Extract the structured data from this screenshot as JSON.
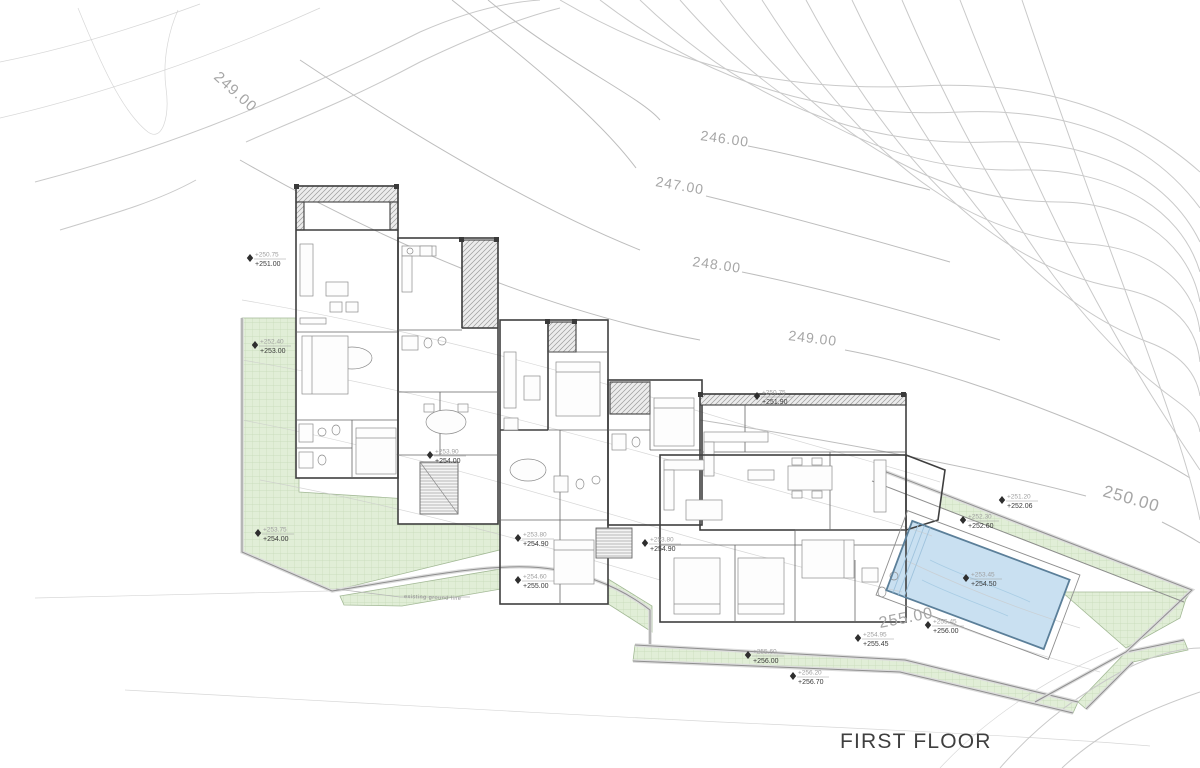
{
  "title": {
    "label": "FIRST FLOOR"
  },
  "plan": {
    "contour_labels": [
      {
        "text": "249.00",
        "x": 213,
        "y": 78,
        "rot": 42,
        "size": 15
      },
      {
        "text": "246.00",
        "x": 700,
        "y": 140,
        "rot": 8,
        "size": 14
      },
      {
        "text": "247.00",
        "x": 655,
        "y": 186,
        "rot": 10,
        "size": 14
      },
      {
        "text": "248.00",
        "x": 692,
        "y": 266,
        "rot": 8,
        "size": 14
      },
      {
        "text": "249.00",
        "x": 788,
        "y": 340,
        "rot": 7,
        "size": 14
      },
      {
        "text": "250.00",
        "x": 1102,
        "y": 496,
        "rot": 16,
        "size": 17
      },
      {
        "text": "255.00",
        "x": 880,
        "y": 628,
        "rot": -11,
        "size": 16
      }
    ],
    "elevation_markers": [
      {
        "existing": "+250.75",
        "proposed": "+251.00",
        "x": 250,
        "y": 258
      },
      {
        "existing": "+252.40",
        "proposed": "+253.00",
        "x": 255,
        "y": 345
      },
      {
        "existing": "+253.90",
        "proposed": "+254.00",
        "x": 430,
        "y": 455
      },
      {
        "existing": "+253.75",
        "proposed": "+254.00",
        "x": 258,
        "y": 533
      },
      {
        "existing": "+253.80",
        "proposed": "+254.90",
        "x": 518,
        "y": 538
      },
      {
        "existing": "+253.80",
        "proposed": "+254.90",
        "x": 645,
        "y": 543
      },
      {
        "existing": "+254.60",
        "proposed": "+255.00",
        "x": 518,
        "y": 580
      },
      {
        "existing": "+250.75",
        "proposed": "+251.90",
        "x": 757,
        "y": 396
      },
      {
        "existing": "+255.60",
        "proposed": "+256.00",
        "x": 748,
        "y": 655
      },
      {
        "existing": "+256.20",
        "proposed": "+256.70",
        "x": 793,
        "y": 676
      },
      {
        "existing": "+254.95",
        "proposed": "+255.45",
        "x": 858,
        "y": 638
      },
      {
        "existing": "+255.45",
        "proposed": "+256.00",
        "x": 928,
        "y": 625
      },
      {
        "existing": "+251.20",
        "proposed": "+252.06",
        "x": 1002,
        "y": 500
      },
      {
        "existing": "+252.30",
        "proposed": "+252.60",
        "x": 963,
        "y": 520
      },
      {
        "existing": "+253.45",
        "proposed": "+254.50",
        "x": 966,
        "y": 578
      }
    ],
    "annotation": {
      "text": "existing ground line",
      "x": 404,
      "y": 598,
      "rot": 2
    },
    "colors": {
      "contour": "#c9c9c9",
      "green_fill": "#e1eed7",
      "green_grid": "#c6dab8",
      "pool_fill": "#c3ddf0",
      "pool_edge": "#5b7f99",
      "wall": "#3f3f3f",
      "boundary": "#8f8f8f",
      "contour_label": "#a6a6a6",
      "title": "#3f3f3f"
    }
  }
}
